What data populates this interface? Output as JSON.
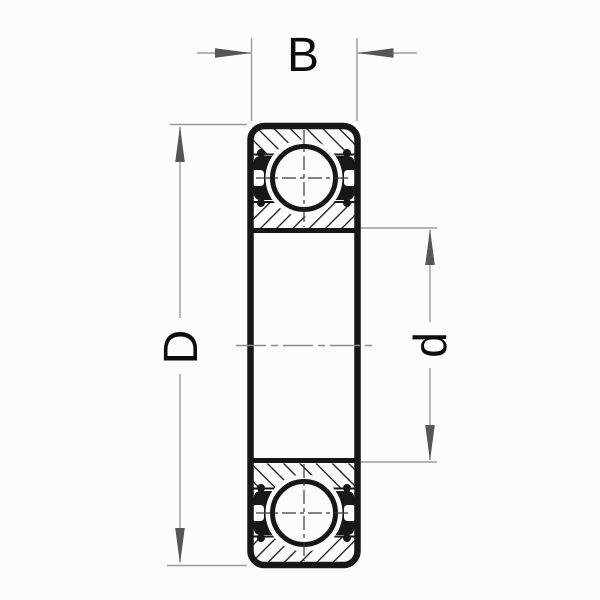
{
  "drawing": {
    "kind": "bearing-cross-section",
    "labels": {
      "width": "B",
      "outer_diameter": "D",
      "bore_diameter": "d"
    }
  },
  "colors": {
    "ink": "#171717",
    "dimension_line": "#9b9b9b",
    "arrow": "#565656",
    "centerline": "#8a8a8a",
    "background": "#fcfcfc"
  }
}
